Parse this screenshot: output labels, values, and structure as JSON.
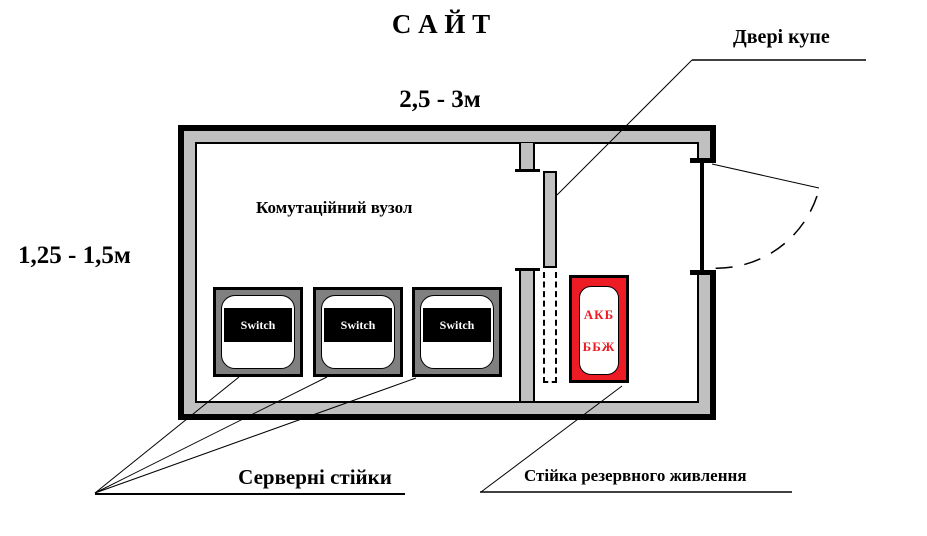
{
  "diagram": {
    "title": "С А Й Т",
    "top_dimension": "2,5 - 3м",
    "left_dimension": "1,25 - 1,5м",
    "room_label": "Комутаційний вузол",
    "door_label": "Двері купе",
    "switch_racks": [
      {
        "label": "Switch"
      },
      {
        "label": "Switch"
      },
      {
        "label": "Switch"
      }
    ],
    "switch_racks_caption": "Серверні стійки",
    "reserve_rack": {
      "line1": "АКБ",
      "line2": "ББЖ"
    },
    "reserve_rack_caption": "Стійка резервного живлення",
    "colors": {
      "wall_fill": "#c0c0c0",
      "switch_rack_fill": "#808080",
      "reserve_rack_fill": "#ed1c24",
      "reserve_rack_text": "#ed1c24",
      "outline": "#000000"
    }
  }
}
